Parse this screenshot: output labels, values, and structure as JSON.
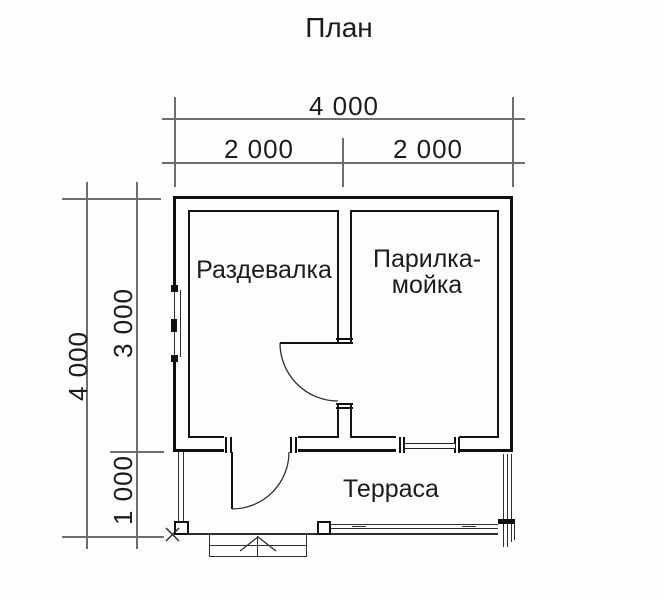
{
  "title": "План",
  "dims": {
    "top_total": "4 000",
    "top_left": "2 000",
    "top_right": "2 000",
    "left_total": "4 000",
    "left_upper": "3 000",
    "left_lower": "1 000"
  },
  "rooms": {
    "changing": "Раздевалка",
    "steam_line1": "Парилка-",
    "steam_line2": "мойка",
    "terrace": "Терраса"
  },
  "colors": {
    "background": "#fdfdfd",
    "wall": "#101010",
    "dimension_line": "#6e6e6e",
    "thin_line": "#2e2e2e",
    "text": "#1c1c1c"
  }
}
